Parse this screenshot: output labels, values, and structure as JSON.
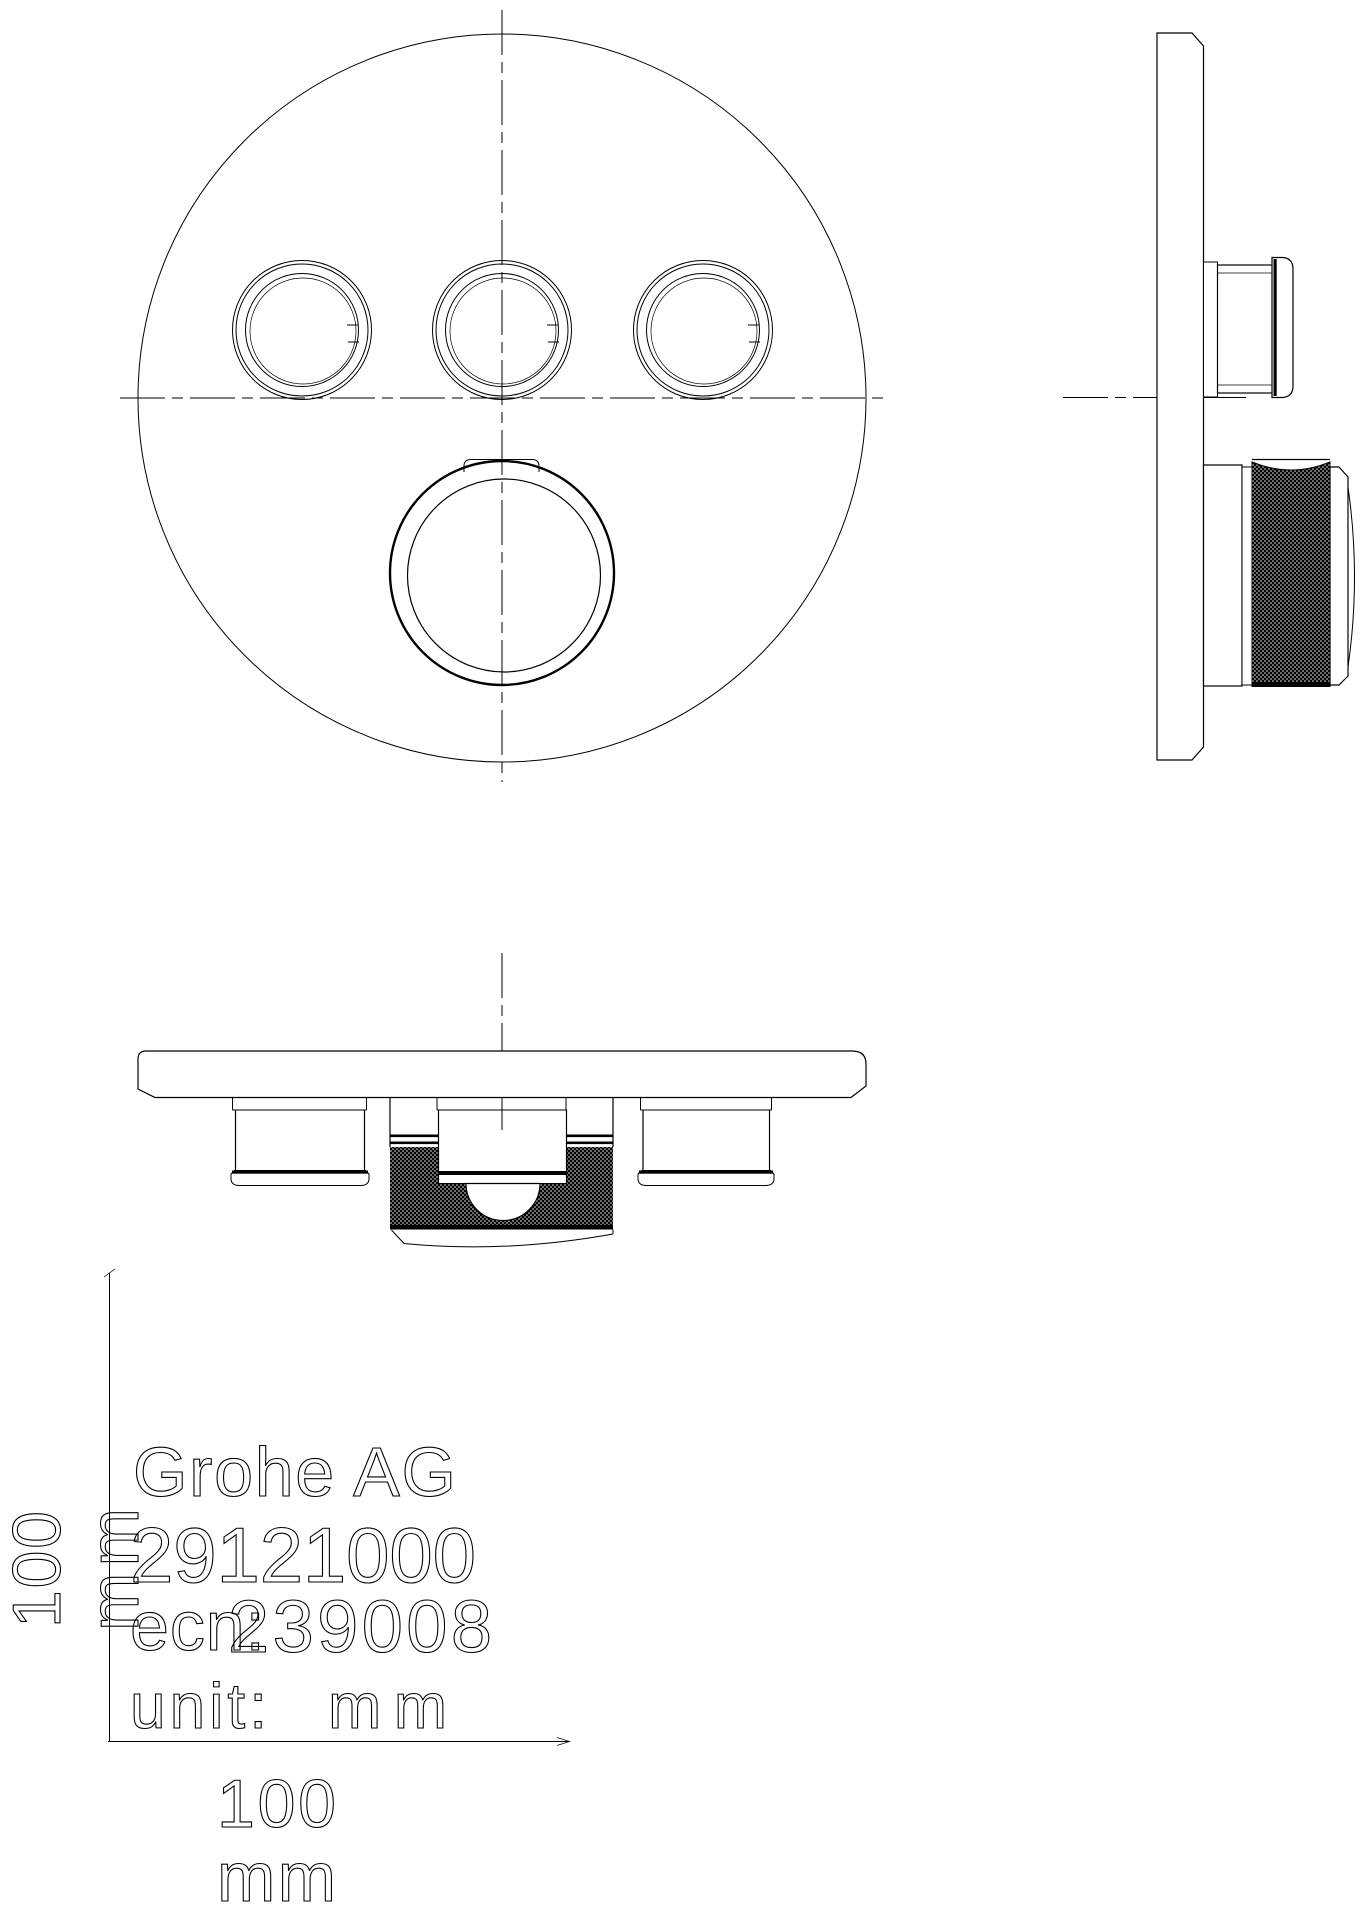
{
  "colors": {
    "line": "#000000",
    "background": "#ffffff",
    "knurl_fill": "#000000"
  },
  "titleblock": {
    "company": "Grohe AG",
    "part_number": "29121000",
    "ecn_label": "ecn:",
    "ecn_number": "239008",
    "unit_label": "unit:",
    "unit_value": "mm"
  },
  "dimensions": {
    "width": {
      "value": "100",
      "unit": "mm"
    },
    "height": {
      "value": "100",
      "unit": "mm"
    }
  }
}
